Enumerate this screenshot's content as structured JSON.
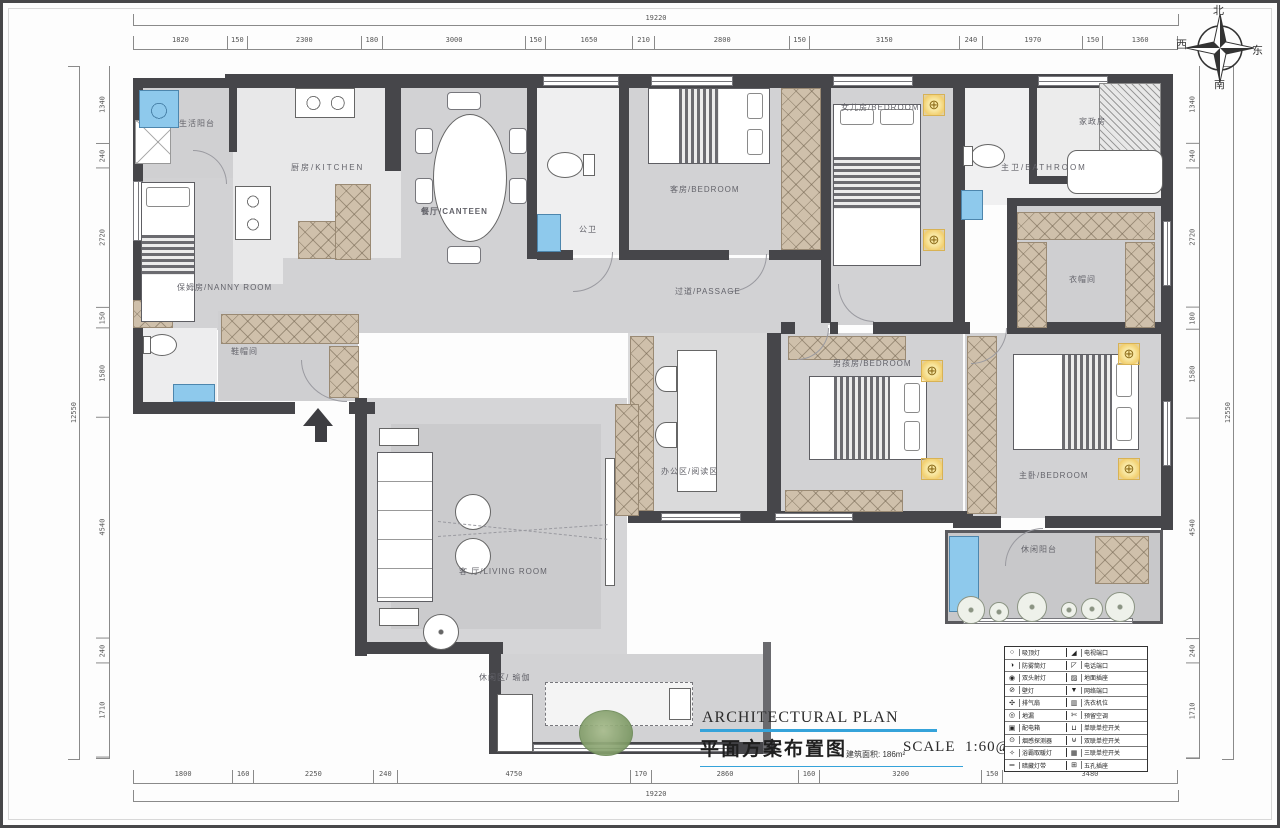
{
  "title_block": {
    "title_en": "ARCHITECTURAL PLAN",
    "title_cn": "平面方案布置图",
    "area": "建筑面积: 186m²",
    "scale_label": "SCALE",
    "scale_value": "1:60@A3"
  },
  "compass": {
    "north": "北",
    "south": "南",
    "west": "西",
    "east": "东"
  },
  "icons": {
    "light": "⊕"
  },
  "rooms": {
    "laundry_balcony": "生活阳台",
    "kitchen": "厨房/KITCHEN",
    "canteen": "餐厅/CANTEEN",
    "public_wc": "公卫",
    "guest_bedroom": "客房/BEDROOM",
    "daughter_bedroom": "女儿房/BEDROOM",
    "housekeeping": "家政房",
    "master_bath": "主卫/BATHROOM",
    "cloakroom": "衣帽间",
    "nanny_room": "保姆房/NANNY ROOM",
    "shoe_room": "鞋帽间",
    "passage": "过道/PASSAGE",
    "office_reading": "办公区/阅读区",
    "boy_bedroom": "男孩房/BEDROOM",
    "master_bedroom": "主卧/BEDROOM",
    "leisure_balcony": "休闲阳台",
    "living_room": "客 厅/LIVING ROOM",
    "leisure_yoga": "休闲区/ 瑜伽"
  },
  "dims": {
    "top": {
      "overall": "19220",
      "values": [
        "1820",
        "150",
        "2300",
        "180",
        "3000",
        "150",
        "1650",
        "210",
        "2800",
        "150",
        "3150",
        "240",
        "1970",
        "150",
        "1360"
      ]
    },
    "bottom": {
      "overall": "19220",
      "values": [
        "1800",
        "160",
        "2250",
        "240",
        "4750",
        "170",
        "2860",
        "160",
        "3200",
        "150",
        "3480"
      ]
    },
    "left": {
      "overall": "12550",
      "values": [
        "1340",
        "240",
        "2720",
        "150",
        "1580",
        "4540",
        "240",
        "1710"
      ]
    },
    "right": {
      "overall": "12550",
      "values": [
        "1340",
        "240",
        "2720",
        "180",
        "1580",
        "4540",
        "240",
        "1710"
      ]
    }
  },
  "legend": {
    "rows": [
      {
        "i1": "○",
        "l1": "吸顶灯",
        "i2": "◢",
        "l2": "电视端口"
      },
      {
        "i1": "◑",
        "l1": "防雾筒灯",
        "i2": "◸",
        "l2": "电话端口"
      },
      {
        "i1": "◉",
        "l1": "双头射灯",
        "i2": "▨",
        "l2": "地面插座"
      },
      {
        "i1": "⊘",
        "l1": "壁灯",
        "i2": "▼",
        "l2": "网络端口"
      },
      {
        "i1": "✣",
        "l1": "排气扇",
        "i2": "▥",
        "l2": "洗衣机位"
      },
      {
        "i1": "◎",
        "l1": "地漏",
        "i2": "✄",
        "l2": "预留空调"
      },
      {
        "i1": "▣",
        "l1": "配电箱",
        "i2": "⊔",
        "l2": "单联单控开关"
      },
      {
        "i1": "⊙",
        "l1": "烟感探测器",
        "i2": "⊎",
        "l2": "双联单控开关"
      },
      {
        "i1": "✧",
        "l1": "浴霸取暖灯",
        "i2": "▦",
        "l2": "三联单控开关"
      },
      {
        "i1": "═",
        "l1": "暗藏灯带",
        "i2": "⊞",
        "l2": "五孔插座"
      }
    ]
  }
}
